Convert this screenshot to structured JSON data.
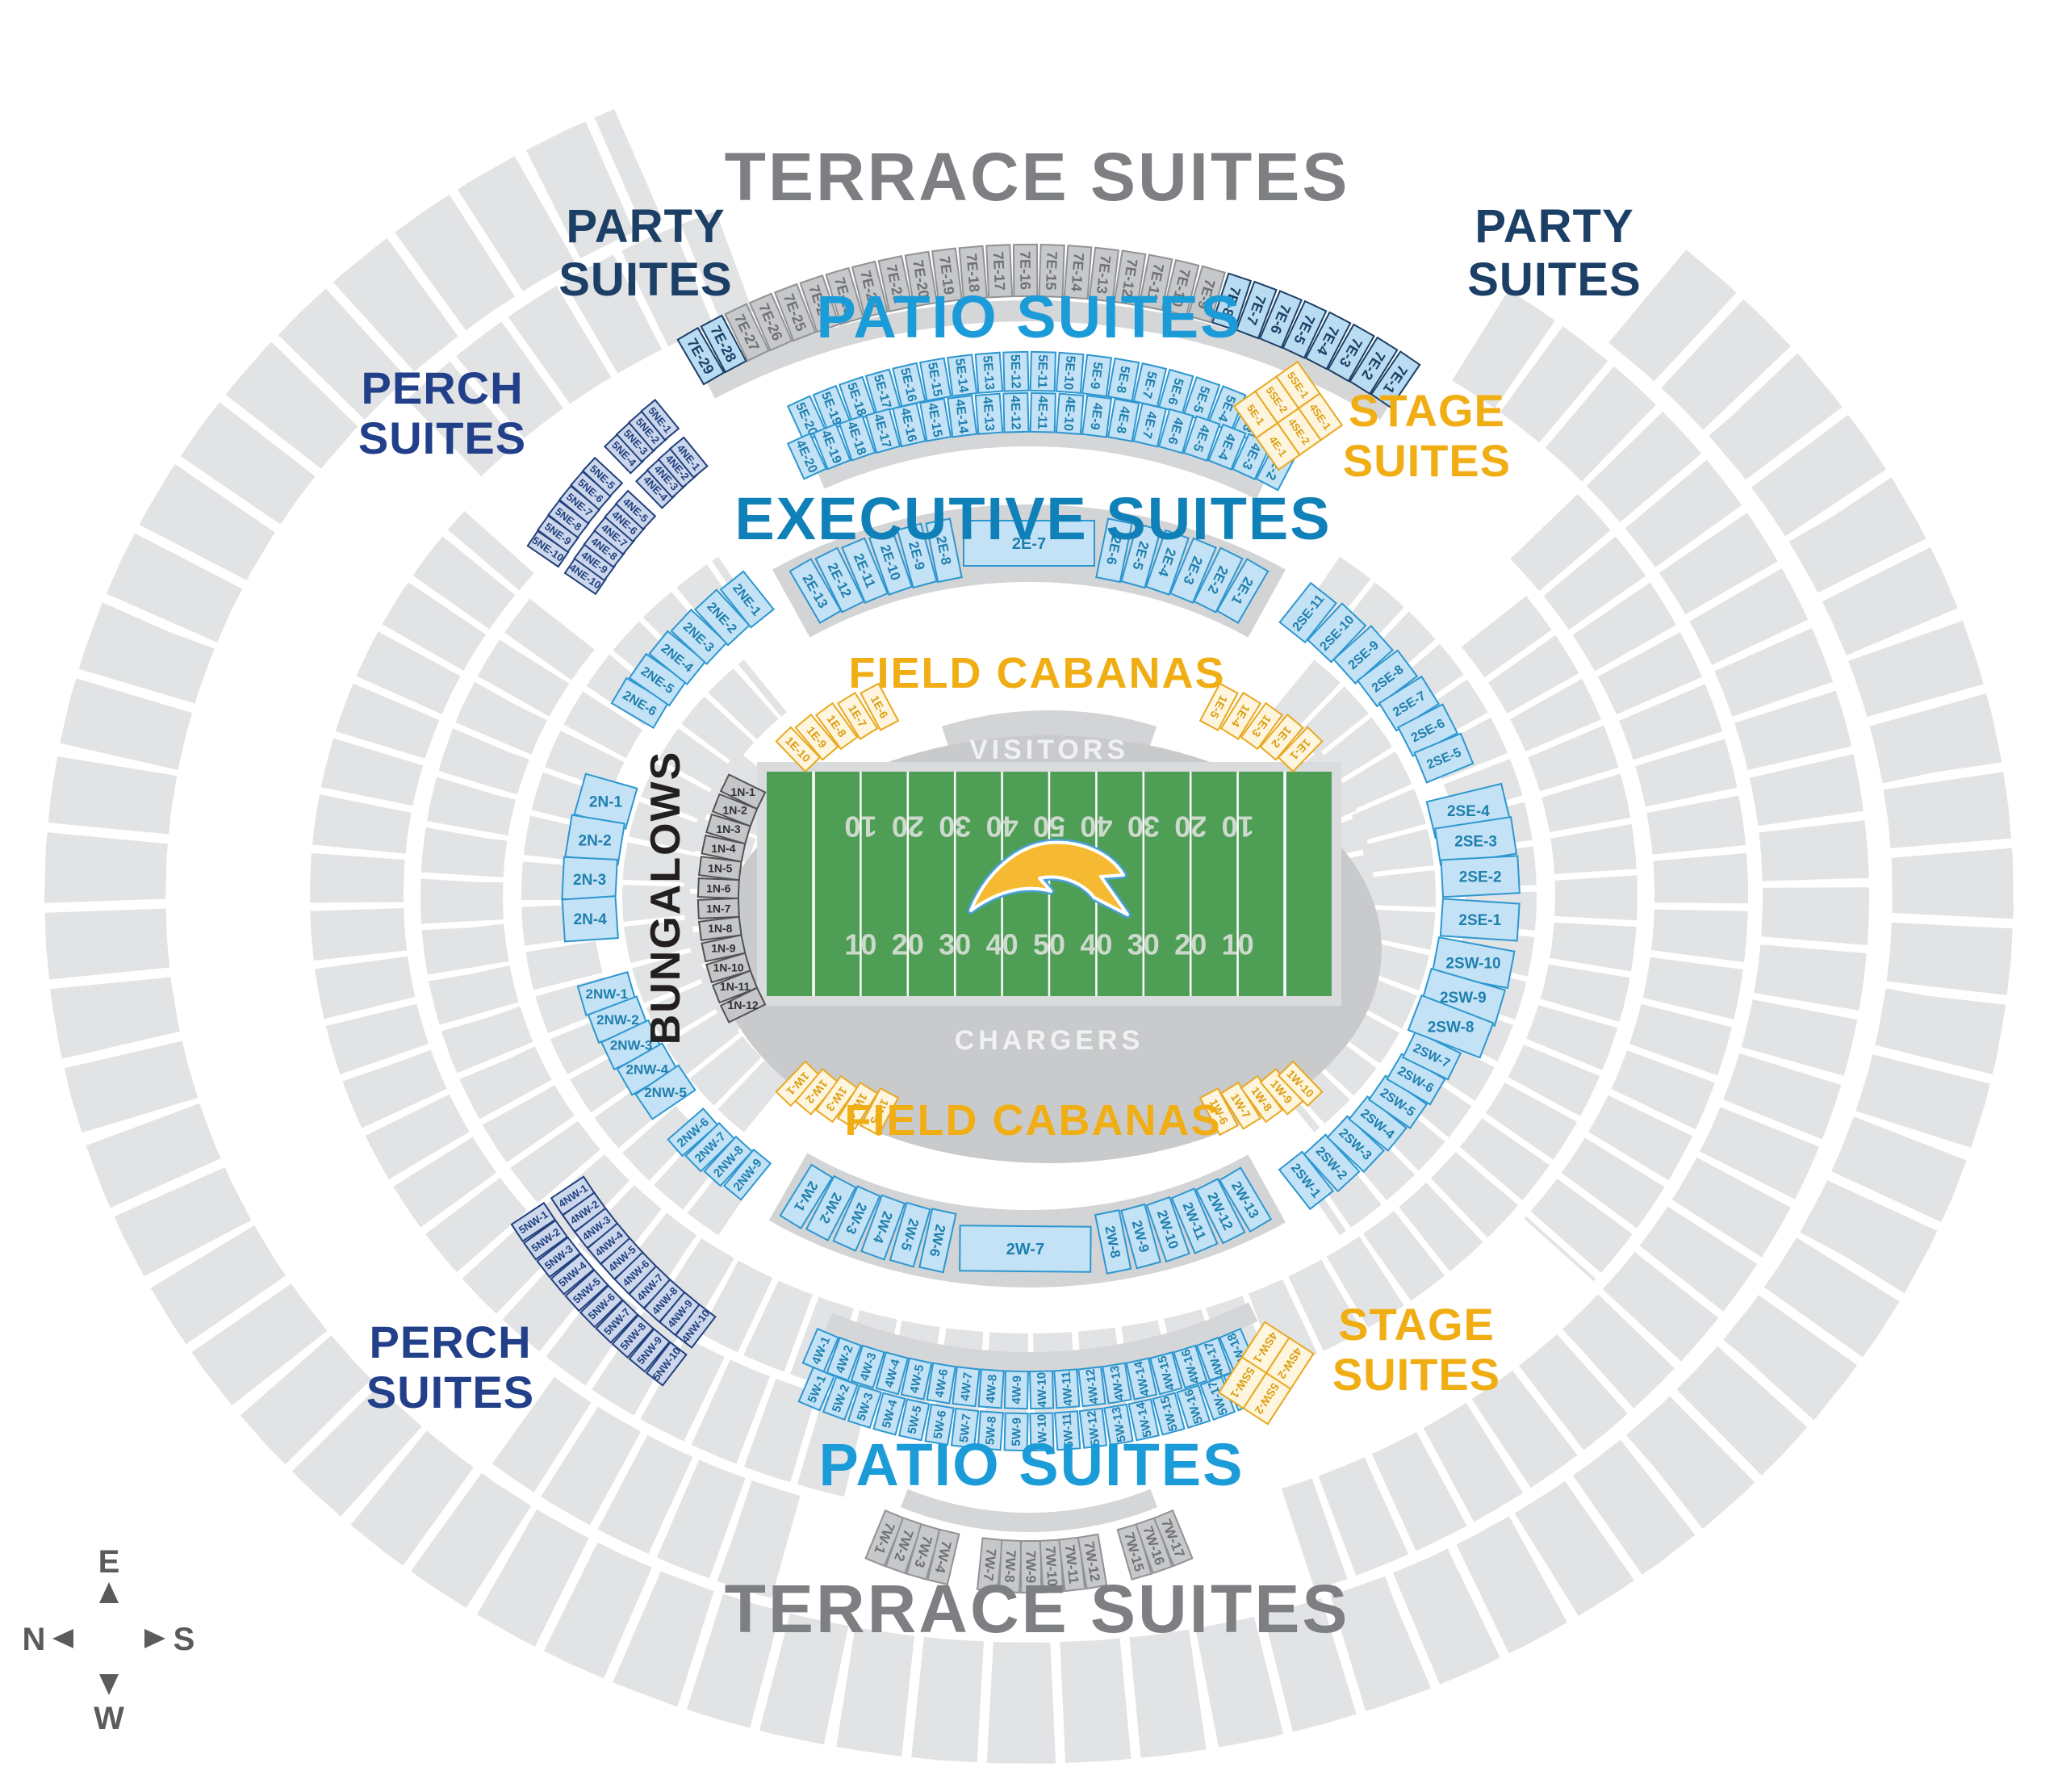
{
  "map_title": "SoFi Stadium Suites Seat Map - Chargers",
  "colors": {
    "section_gray": "#e2e3e5",
    "walkway_gray": "#d5d6d8",
    "exec_band_gray": "#d3d4d6",
    "floor_gray": "#c9cacc",
    "field_frame": "#dadbdd",
    "field_green": "#4f9e55",
    "field_line": "#ffffff",
    "yard_number": "#cdd9cd",
    "terrace_fill": "#c7c8ca",
    "terrace_stroke": "#909295",
    "terrace_text": "#6f7174",
    "party_fill": "#badcf2",
    "party_stroke": "#1c3f66",
    "party_text": "#1c3f66",
    "blue_fill": "#c3e2f6",
    "blue_stroke": "#2d97d0",
    "blue_text": "#1f7fad",
    "perch_fill": "#ccd7ec",
    "perch_stroke": "#22407e",
    "perch_text": "#22407e",
    "gold_fill": "#fdf5de",
    "gold_stroke": "#e9a81f",
    "gold_text": "#dc9e11",
    "bungalow_fill": "#c5c6c8",
    "bungalow_stroke": "#515254",
    "bungalow_text": "#2f3032",
    "title_terrace": "#7d7f82",
    "title_party": "#1c3f66",
    "title_patio": "#1b9cd9",
    "title_perch": "#223f8a",
    "title_gold": "#f0ae14",
    "title_exec": "#0f81b8",
    "title_black": "#231f20",
    "team_text": "#f0f1f2",
    "compass": "#5a5b5d",
    "bolt_gold": "#f6b932",
    "bolt_blue": "#4aa0d8"
  },
  "titles": {
    "terrace_top": {
      "lines": [
        "TERRACE SUITES"
      ]
    },
    "party_left": {
      "lines": [
        "PARTY",
        "SUITES"
      ]
    },
    "party_right": {
      "lines": [
        "PARTY",
        "SUITES"
      ]
    },
    "patio_top": {
      "lines": [
        "PATIO SUITES"
      ]
    },
    "perch_top": {
      "lines": [
        "PERCH",
        "SUITES"
      ]
    },
    "stage_top": {
      "lines": [
        "STAGE",
        "SUITES"
      ]
    },
    "executive": {
      "lines": [
        "EXECUTIVE SUITES"
      ]
    },
    "cabanas_top": {
      "lines": [
        "FIELD CABANAS"
      ]
    },
    "bungalows": {
      "lines": [
        "BUNGALOWS"
      ]
    },
    "cabanas_bottom": {
      "lines": [
        "FIELD CABANAS"
      ]
    },
    "perch_bottom": {
      "lines": [
        "PERCH",
        "SUITES"
      ]
    },
    "stage_bottom": {
      "lines": [
        "STAGE",
        "SUITES"
      ]
    },
    "patio_bottom": {
      "lines": [
        "PATIO SUITES"
      ]
    },
    "terrace_bottom": {
      "lines": [
        "TERRACE SUITES"
      ]
    }
  },
  "field": {
    "away_label": "VISITORS",
    "home_label": "CHARGERS",
    "yard_numbers": [
      "10",
      "20",
      "30",
      "40",
      "50",
      "40",
      "30",
      "20",
      "10"
    ]
  },
  "compass": {
    "top": "E",
    "left": "N",
    "right": "S",
    "bottom": "W"
  },
  "suite_groups": {
    "terrace_top": {
      "labels": [
        "7E-29",
        "7E-28",
        "7E-27",
        "7E-26",
        "7E-25",
        "7E-24",
        "7E-23",
        "7E-22",
        "7E-21",
        "7E-20",
        "7E-19",
        "7E-18",
        "7E-17",
        "7E-16",
        "7E-15",
        "7E-14",
        "7E-13",
        "7E-12",
        "7E-11",
        "7E-10",
        "7E-9",
        "7E-8",
        "7E-7",
        "7E-6",
        "7E-5",
        "7E-4",
        "7E-3",
        "7E-2",
        "7E-1"
      ],
      "party_sections": [
        "7E-29",
        "7E-28",
        "7E-8",
        "7E-7",
        "7E-6",
        "7E-5",
        "7E-4",
        "7E-3",
        "7E-2",
        "7E-1"
      ]
    },
    "patio_top_outer": {
      "labels": [
        "5E-20",
        "5E-19",
        "5E-18",
        "5E-17",
        "5E-16",
        "5E-15",
        "5E-14",
        "5E-13",
        "5E-12",
        "5E-11",
        "5E-10",
        "5E-9",
        "5E-8",
        "5E-7",
        "5E-6",
        "5E-5",
        "5E-4",
        "5E-3",
        "5E-2"
      ]
    },
    "patio_top_inner": {
      "labels": [
        "4E-20",
        "4E-19",
        "4E-18",
        "4E-17",
        "4E-16",
        "4E-15",
        "4E-14",
        "4E-13",
        "4E-12",
        "4E-11",
        "4E-10",
        "4E-9",
        "4E-8",
        "4E-7",
        "4E-6",
        "4E-5",
        "4E-4",
        "4E-3",
        "4E-2"
      ]
    },
    "perch_top_outer_b": {
      "labels": [
        "5NE-10",
        "5NE-9",
        "5NE-8",
        "5NE-7",
        "5NE-6",
        "5NE-5"
      ]
    },
    "perch_top_inner_b": {
      "labels": [
        "4NE-10",
        "4NE-9",
        "4NE-8",
        "4NE-7",
        "4NE-6",
        "4NE-5"
      ]
    },
    "perch_top_outer_a": {
      "labels": [
        "5NE-4",
        "5NE-3",
        "5NE-2",
        "5NE-1"
      ]
    },
    "perch_top_inner_a": {
      "labels": [
        "4NE-4",
        "4NE-3",
        "4NE-2",
        "4NE-1"
      ]
    },
    "exec_top": {
      "labels": [
        "2E-13",
        "2E-12",
        "2E-11",
        "2E-10",
        "2E-9",
        "2E-8",
        "2E-7",
        "2E-6",
        "2E-5",
        "2E-4",
        "2E-3",
        "2E-2",
        "2E-1"
      ]
    },
    "exec_ne": {
      "labels": [
        "2NE-6",
        "2NE-5",
        "2NE-4",
        "2NE-3",
        "2NE-2",
        "2NE-1"
      ]
    },
    "exec_n": {
      "labels": [
        "2N-1",
        "2N-2",
        "2N-3",
        "2N-4"
      ]
    },
    "exec_nw_a": {
      "labels": [
        "2NW-1",
        "2NW-2",
        "2NW-3",
        "2NW-4",
        "2NW-5"
      ]
    },
    "exec_nw_b": {
      "labels": [
        "2NW-6",
        "2NW-7",
        "2NW-8",
        "2NW-9"
      ]
    },
    "exec_bottom": {
      "labels": [
        "2W-1",
        "2W-2",
        "2W-3",
        "2W-4",
        "2W-5",
        "2W-6",
        "2W-7",
        "2W-8",
        "2W-9",
        "2W-10",
        "2W-11",
        "2W-12",
        "2W-13"
      ]
    },
    "exec_sw": {
      "labels": [
        "2SW-1",
        "2SW-2",
        "2SW-3",
        "2SW-4",
        "2SW-5",
        "2SW-6",
        "2SW-7"
      ]
    },
    "exec_right_stack": {
      "labels": [
        "2SE-4",
        "2SE-3",
        "2SE-2",
        "2SE-1",
        "2SW-10",
        "2SW-9",
        "2SW-8"
      ]
    },
    "exec_se": {
      "labels": [
        "2SE-11",
        "2SE-10",
        "2SE-9",
        "2SE-8",
        "2SE-7",
        "2SE-6",
        "2SE-5"
      ]
    },
    "cabanas_top_left": {
      "labels": [
        "1E-10",
        "1E-9",
        "1E-8",
        "1E-7",
        "1E-6"
      ]
    },
    "cabanas_top_right": {
      "labels": [
        "1E-5",
        "1E-4",
        "1E-3",
        "1E-2",
        "1E-1"
      ]
    },
    "cabanas_bottom_left": {
      "labels": [
        "1W-1",
        "1W-2",
        "1W-3",
        "1W-4",
        "1W-5"
      ]
    },
    "cabanas_bottom_right": {
      "labels": [
        "1W-6",
        "1W-7",
        "1W-8",
        "1W-9",
        "1W-10"
      ]
    },
    "bungalows": {
      "labels": [
        "1N-1",
        "1N-2",
        "1N-3",
        "1N-4",
        "1N-5",
        "1N-6",
        "1N-7",
        "1N-8",
        "1N-9",
        "1N-10",
        "1N-11",
        "1N-12"
      ]
    },
    "perch_bottom_outer": {
      "labels": [
        "5NW-1",
        "5NW-2",
        "5NW-3",
        "5NW-4",
        "5NW-5",
        "5NW-6",
        "5NW-7",
        "5NW-8",
        "5NW-9",
        "5NW-10"
      ]
    },
    "perch_bottom_inner": {
      "labels": [
        "4NW-1",
        "4NW-2",
        "4NW-3",
        "4NW-4",
        "4NW-5",
        "4NW-6",
        "4NW-7",
        "4NW-8",
        "4NW-9",
        "4NW-10"
      ]
    },
    "patio_bottom_inner": {
      "labels": [
        "4W-1",
        "4W-2",
        "4W-3",
        "4W-4",
        "4W-5",
        "4W-6",
        "4W-7",
        "4W-8",
        "4W-9",
        "4W-10",
        "4W-11",
        "4W-12",
        "4W-13",
        "4W-14",
        "4W-15",
        "4W-16",
        "4W-17",
        "4W-18"
      ]
    },
    "patio_bottom_outer": {
      "labels": [
        "5W-1",
        "5W-2",
        "5W-3",
        "5W-4",
        "5W-5",
        "5W-6",
        "5W-7",
        "5W-8",
        "5W-9",
        "5W-10",
        "5W-11",
        "5W-12",
        "5W-13",
        "5W-14",
        "5W-15",
        "5W-16",
        "5W-17",
        "5W-18"
      ]
    },
    "terrace_bottom": {
      "labels": [
        "7W-1",
        "7W-2",
        "7W-3",
        "7W-4",
        "7W-7",
        "7W-8",
        "7W-9",
        "7W-10",
        "7W-11",
        "7W-12",
        "7W-15",
        "7W-16",
        "7W-17"
      ]
    }
  },
  "stage_suites": {
    "top": {
      "rows": [
        [
          "5E-1",
          "5SE-2",
          "5SE-1"
        ],
        [
          "4E-1",
          "4SE-2",
          "4SE-1"
        ]
      ]
    },
    "bottom": {
      "rows": [
        [
          "4SW-1",
          "4SW-2"
        ],
        [
          "5SW-1",
          "5SW-2"
        ]
      ]
    }
  }
}
